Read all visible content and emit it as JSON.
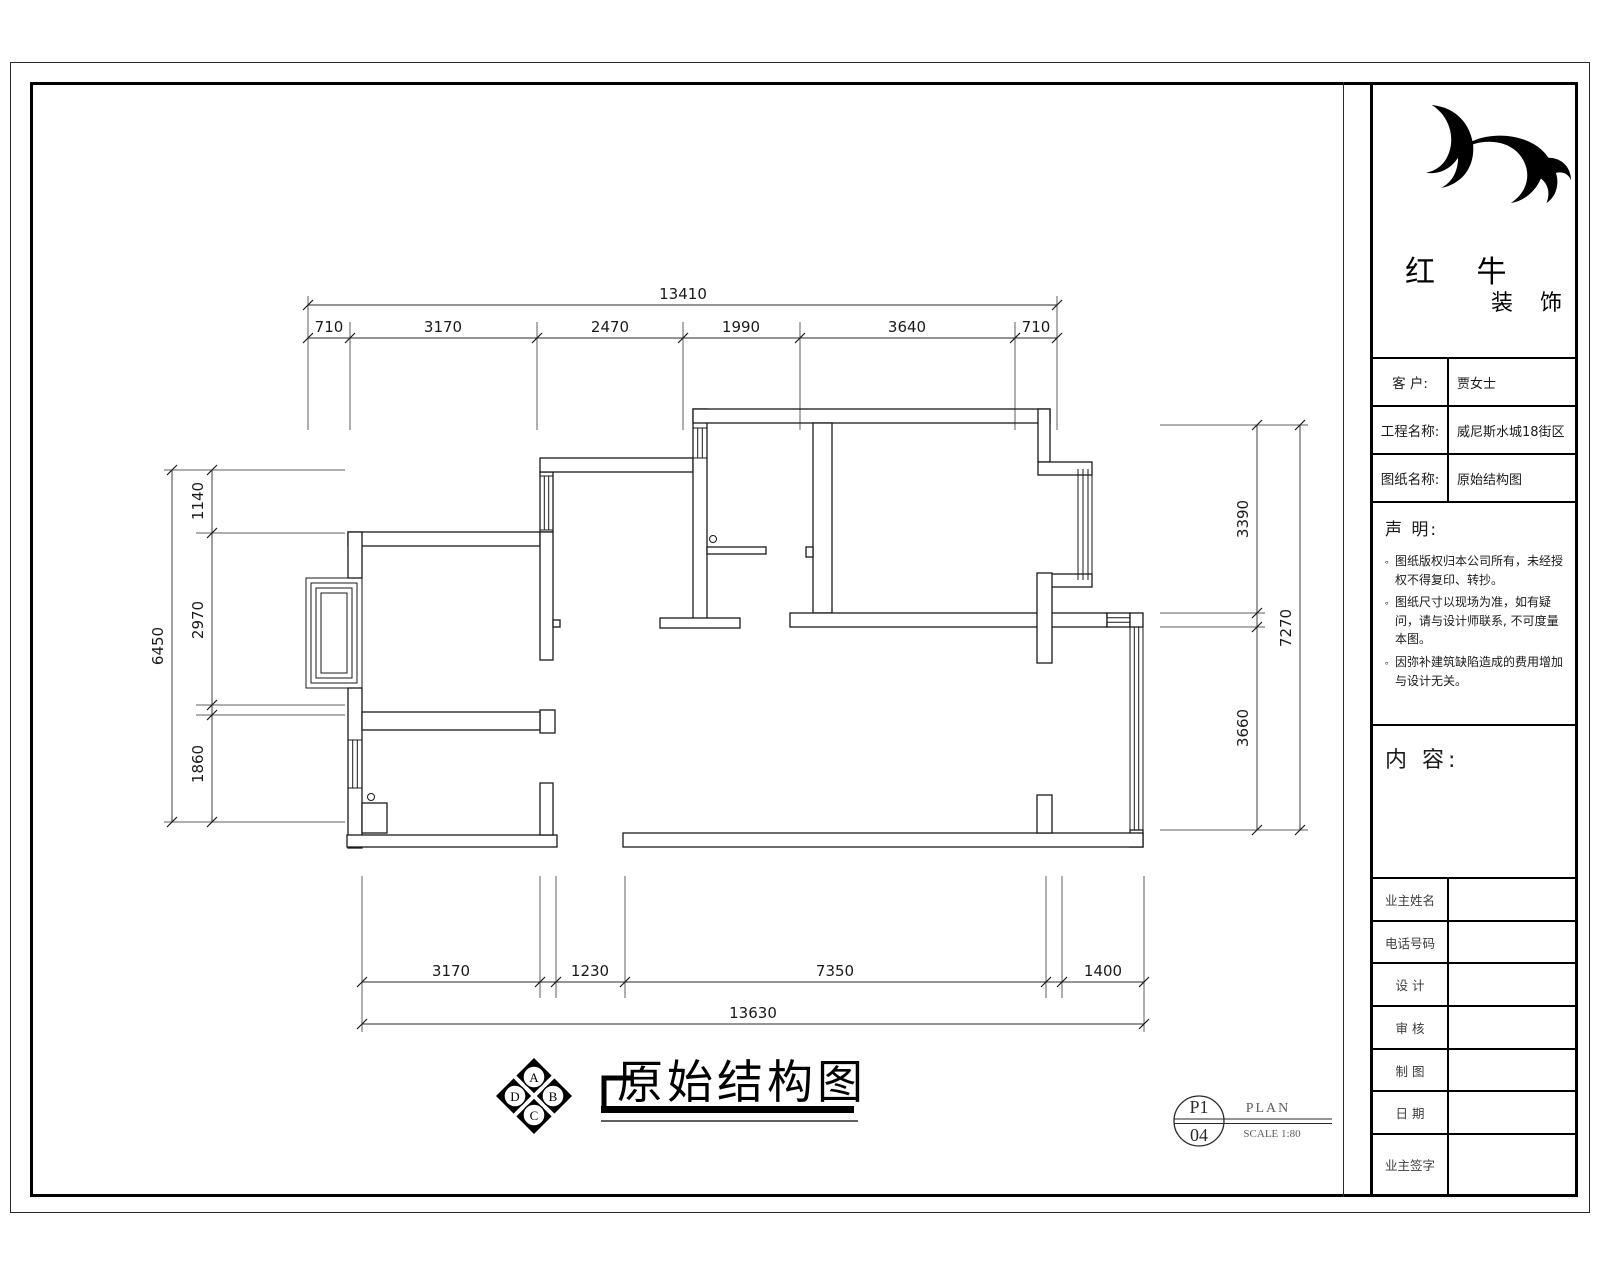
{
  "title_block": {
    "logo": {
      "name_line1": "红 牛",
      "name_line2": "装 饰"
    },
    "info_rows": [
      {
        "label": "客  户:",
        "value": "贾女士"
      },
      {
        "label": "工程名称:",
        "value": "威尼斯水城18街区"
      },
      {
        "label": "图纸名称:",
        "value": "原始结构图"
      }
    ],
    "declaration": {
      "title": "声 明:",
      "bullet": "。",
      "items": [
        "图纸版权归本公司所有，未经授权不得复印、转抄。",
        "图纸尺寸以现场为准，如有疑问，请与设计师联系, 不可度量本图。",
        "因弥补建筑缺陷造成的费用增加与设计无关。"
      ]
    },
    "content_label": "内 容:",
    "signature_rows": [
      "业主姓名",
      "电话号码",
      "设 计",
      "审 核",
      "制 图",
      "日 期",
      "业主签字"
    ]
  },
  "drawing": {
    "title": "原始结构图",
    "compass": {
      "top": "A",
      "right": "B",
      "bottom": "C",
      "left": "D"
    },
    "stamp": {
      "code": "P1",
      "number": "04",
      "label": "PLAN",
      "scale": "SCALE 1:80"
    }
  },
  "dimensions": {
    "top": {
      "overall": "13410",
      "segments": [
        "710",
        "3170",
        "2470",
        "1990",
        "3640",
        "710"
      ]
    },
    "bottom": {
      "overall": "13630",
      "segments": [
        "3170",
        "1230",
        "7350",
        "1400"
      ]
    },
    "left": {
      "overall": "6450",
      "segments": [
        "1140",
        "2970",
        "1860"
      ]
    },
    "right": {
      "overall": "7270",
      "segments": [
        "3390",
        "3660"
      ]
    }
  },
  "colors": {
    "line": "#1a1a1a",
    "paper": "#ffffff"
  }
}
